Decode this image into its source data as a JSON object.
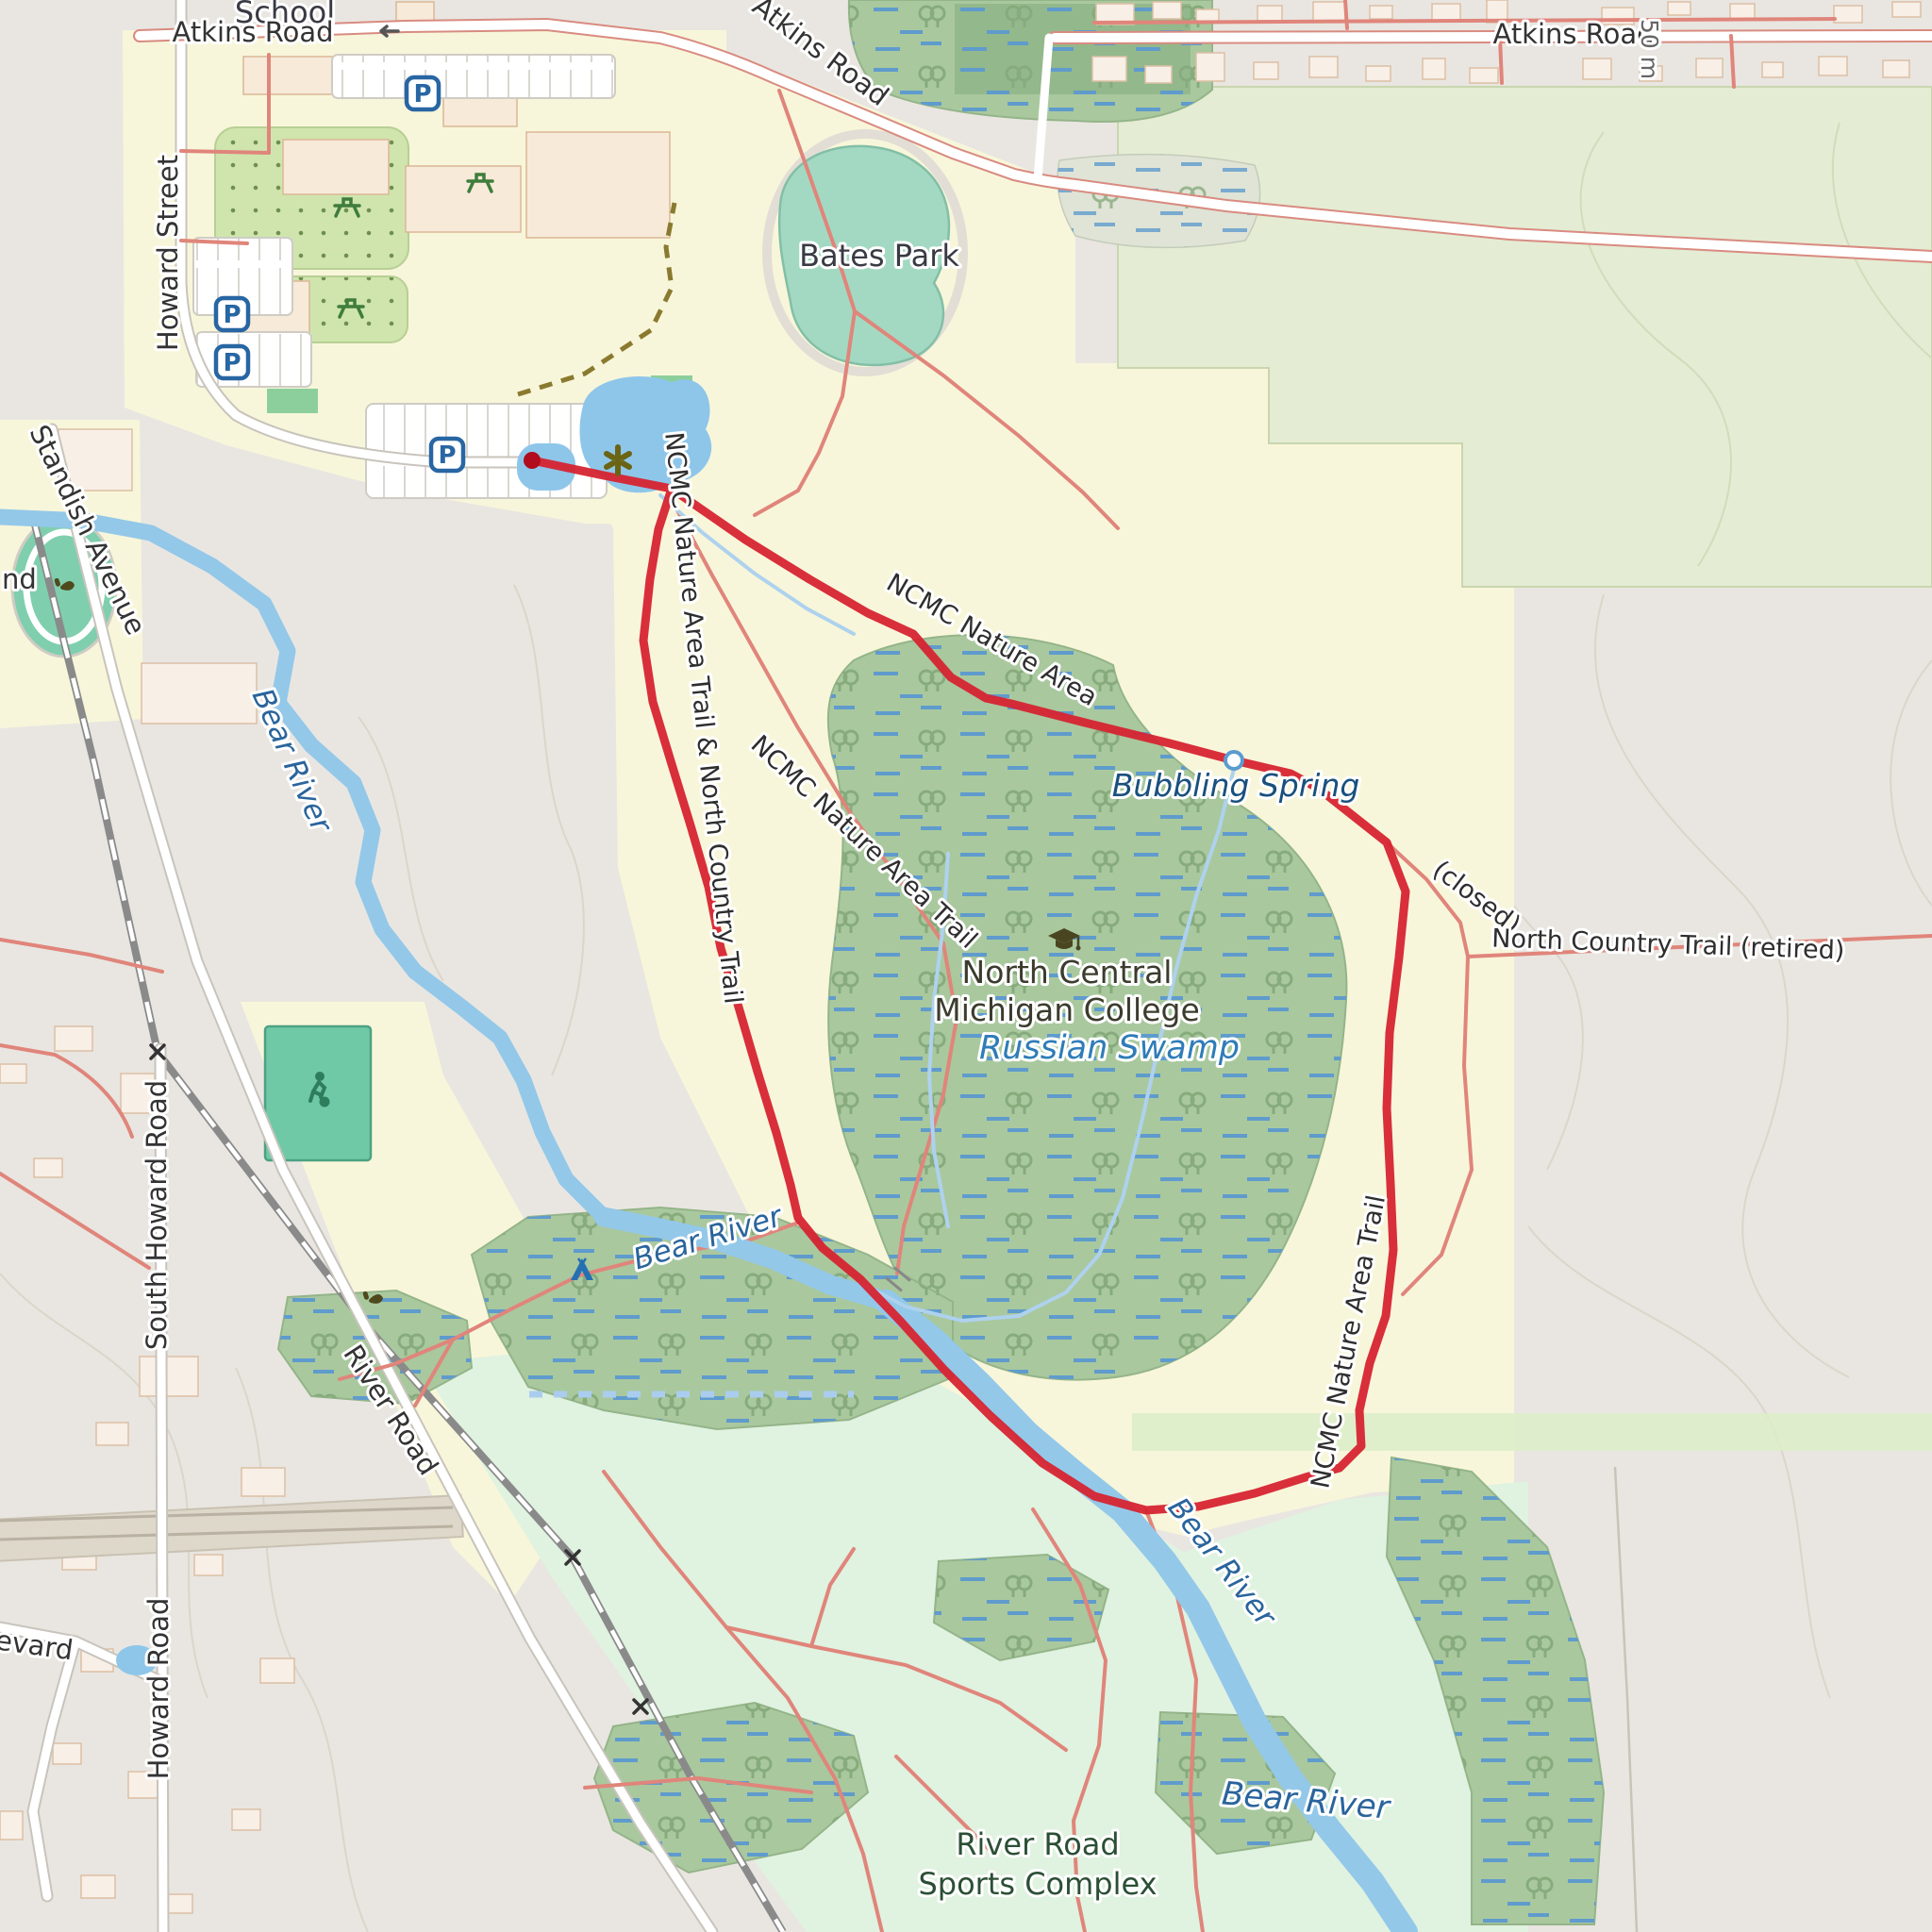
{
  "map": {
    "labels": {
      "school": "School",
      "atkins_road_w": "Atkins Road",
      "atkins_road_mid": "Atkins Road",
      "atkins_road_e": "Atkins Road",
      "scale": "50 m",
      "howard_street": "Howard Street",
      "standish_avenue": "Standish Avenue",
      "cutoff_nd": "nd",
      "cutoff_evard": "evard",
      "bear_river_nw": "Bear River",
      "bear_river_mid": "Bear River",
      "bear_river_se": "Bear River",
      "bear_river_s": "Bear River",
      "bates_park": "Bates Park",
      "trail_left": "NCMC Nature Area Trail & North Country Trail",
      "ncmc_nature_area": "NCMC Nature Area",
      "ncmc_trail_mid": "NCMC Nature Area Trail",
      "ncmc_trail_right": "NCMC Nature Area Trail",
      "bubbling_spring": "Bubbling Spring",
      "closed": "(closed)",
      "nct_retired": "North Country Trail (retired)",
      "college_line1": "North Central",
      "college_line2": "Michigan College",
      "russian_swamp": "Russian Swamp",
      "south_howard_road": "South Howard Road",
      "river_road": "River Road",
      "howard_road": "Howard Road",
      "sports_complex_line1": "River Road",
      "sports_complex_line2": "Sports Complex"
    },
    "icons": {
      "parking_letter": "P",
      "names": [
        "parking-icon",
        "picnic-table-icon",
        "graduation-cap-icon",
        "soccer-pitch-icon",
        "campsite-icon",
        "spring-icon",
        "bubbling-spring-marker-icon",
        "one-way-arrow-icon",
        "level-crossing-icon",
        "athletics-icon"
      ]
    },
    "colors": {
      "route_red": "#d62431",
      "route_start": "#b10d1c",
      "water_blue": "#93c8e9",
      "swamp_green": "#a9c89e",
      "forest_green": "#e4ecd4",
      "park_yellow": "#f8f6da",
      "floodplain_mint": "#e0f2e0",
      "pitch_teal": "#72caa7",
      "road_casing_red": "#d98b80",
      "water_label_blue": "#2a649c"
    }
  },
  "route": {
    "color": "#d62431",
    "width": 9,
    "points": [
      [
        564,
        488
      ],
      [
        640,
        504
      ],
      [
        712,
        518
      ],
      [
        790,
        572
      ],
      [
        858,
        614
      ],
      [
        920,
        650
      ],
      [
        968,
        672
      ],
      [
        1008,
        718
      ],
      [
        1045,
        740
      ],
      [
        1072,
        746
      ],
      [
        1150,
        766
      ],
      [
        1240,
        788
      ],
      [
        1308,
        806
      ],
      [
        1368,
        820
      ],
      [
        1398,
        836
      ],
      [
        1470,
        893
      ],
      [
        1490,
        945
      ],
      [
        1483,
        1015
      ],
      [
        1473,
        1095
      ],
      [
        1470,
        1175
      ],
      [
        1474,
        1255
      ],
      [
        1477,
        1325
      ],
      [
        1469,
        1395
      ],
      [
        1452,
        1445
      ],
      [
        1441,
        1495
      ],
      [
        1443,
        1533
      ],
      [
        1420,
        1556
      ],
      [
        1384,
        1566
      ],
      [
        1330,
        1583
      ],
      [
        1270,
        1597
      ],
      [
        1215,
        1601
      ],
      [
        1160,
        1586
      ],
      [
        1105,
        1551
      ],
      [
        1050,
        1501
      ],
      [
        1000,
        1451
      ],
      [
        955,
        1401
      ],
      [
        912,
        1356
      ],
      [
        872,
        1323
      ],
      [
        846,
        1291
      ],
      [
        838,
        1256
      ],
      [
        823,
        1201
      ],
      [
        803,
        1136
      ],
      [
        784,
        1071
      ],
      [
        764,
        1005
      ],
      [
        751,
        940
      ],
      [
        732,
        875
      ],
      [
        712,
        810
      ],
      [
        692,
        744
      ],
      [
        682,
        679
      ],
      [
        689,
        614
      ],
      [
        698,
        561
      ],
      [
        712,
        518
      ]
    ]
  }
}
